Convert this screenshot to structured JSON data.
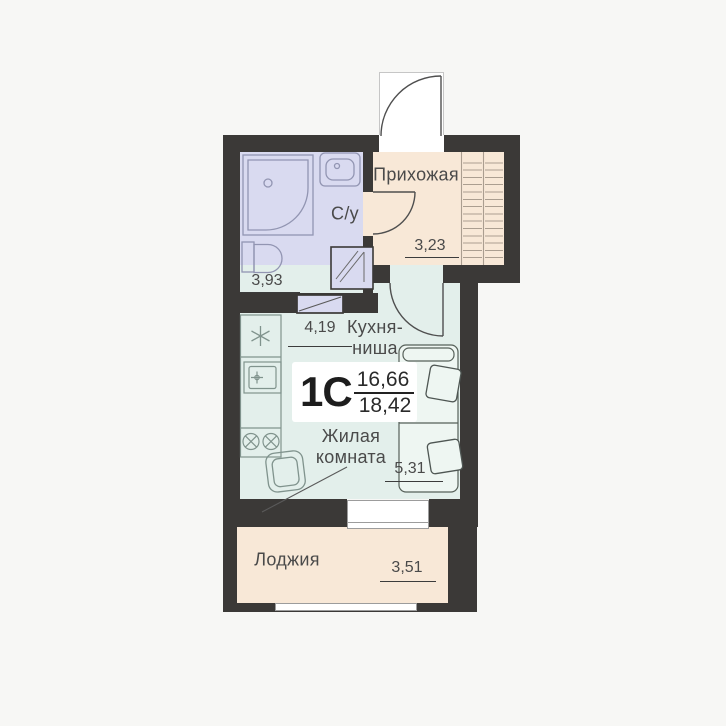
{
  "colors": {
    "background": "#f7f7f5",
    "wall": "#3b3937",
    "bathroom-floor": "#d9daf0",
    "hall-floor": "#f8e8d7",
    "living-floor": "#e3efeb",
    "loggia-floor": "#f8e8d7",
    "bed-fill": "#eef6f2",
    "text": "#4a4a4a",
    "dim-line": "#3c3c3c",
    "bath-stroke": "#9295b2",
    "kitchen-stroke": "#80938d",
    "furniture-stroke": "#566059",
    "hatch-line": "#ab9e90",
    "door-stroke": "#4f4f4f"
  },
  "unit": {
    "type_label": "1С",
    "area_upper": "16,66",
    "area_lower": "18,42"
  },
  "rooms": {
    "hallway": {
      "name": "Прихожая",
      "area": "3,23"
    },
    "bathroom": {
      "name": "С/у",
      "area": "3,93"
    },
    "kitchen": {
      "name": "Кухня-ниша",
      "area": "4,19"
    },
    "living": {
      "name": "Жилая комната",
      "area": "5,31"
    },
    "loggia": {
      "name": "Лоджия",
      "area": "3,51"
    }
  },
  "fixtures": [
    "entrance-door",
    "bathroom-door",
    "living-room-door",
    "shower-tray",
    "washbasin",
    "toilet",
    "vent-shaft",
    "door-panel",
    "wardrobe-hatch",
    "fridge",
    "kitchen-sink",
    "cooktop-2-burner",
    "armchair",
    "bed",
    "pillow",
    "window",
    "loggia-glazing"
  ]
}
